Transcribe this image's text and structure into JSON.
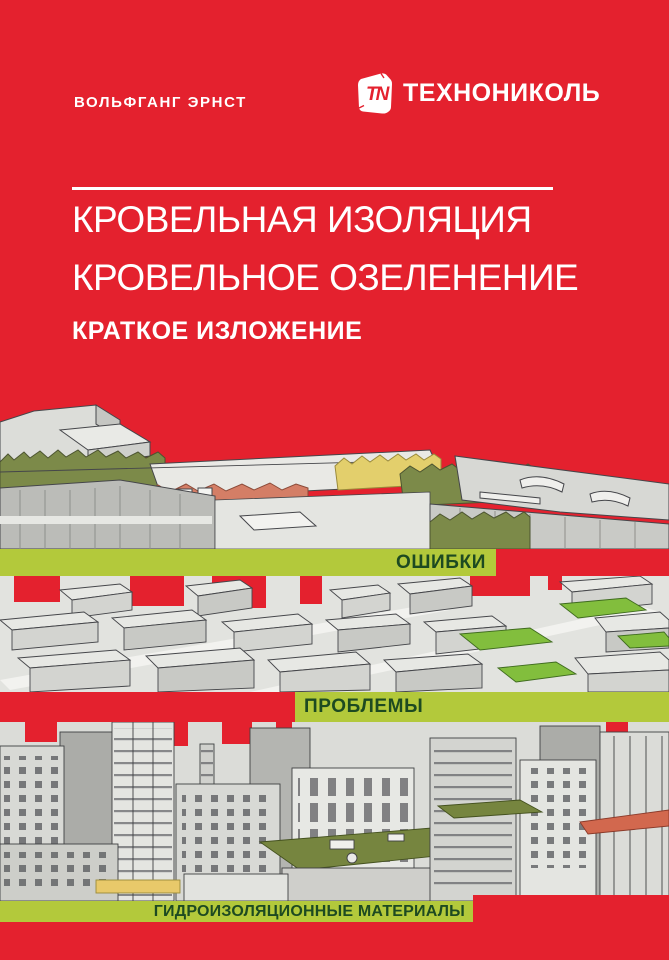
{
  "cover": {
    "author": "ВОЛЬФГАНГ ЭРНСТ",
    "brand": {
      "wordmark": "ТЕХНОНИКОЛЬ",
      "monogram": "TN"
    },
    "title": {
      "line1": "КРОВЕЛЬНАЯ ИЗОЛЯЦИЯ",
      "line2": "КРОВЕЛЬНОЕ ОЗЕЛЕНЕНИЕ",
      "subtitle": "КРАТКОЕ ИЗЛОЖЕНИЕ"
    },
    "banners": {
      "banner1": "ОШИБКИ",
      "banner2": "ПРОБЛЕМЫ",
      "banner3": "ГИДРОИЗОЛЯЦИОННЫЕ МАТЕРИАЛЫ"
    },
    "colors": {
      "background_red": "#E4212E",
      "banner_lime": "#B3C93B",
      "banner_text_green": "#1D4A21",
      "text_white": "#FFFFFF",
      "illustration_grey": "#D6D7D3",
      "roof_olive": "#7C8A49",
      "roof_salmon": "#D47E66",
      "grass_yellow": "#E3CF6C",
      "roof_bright_green": "#82BE3D"
    }
  }
}
